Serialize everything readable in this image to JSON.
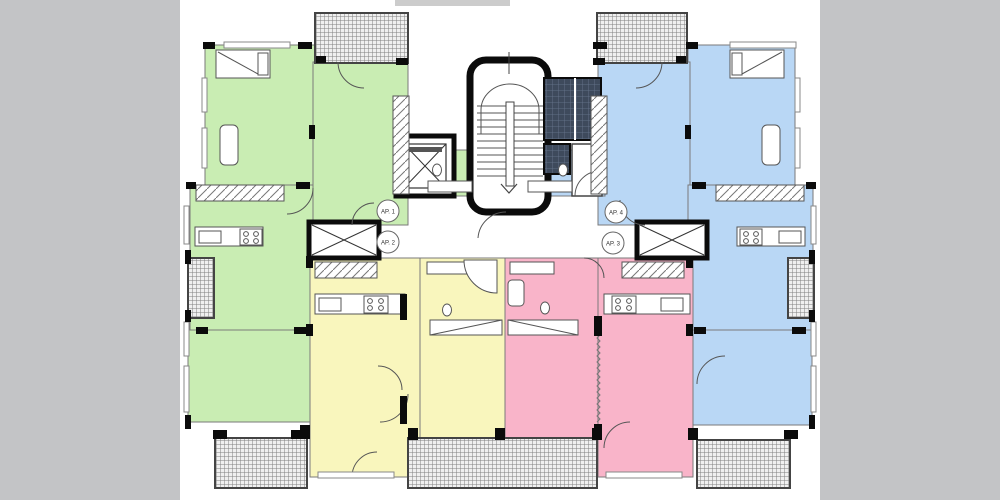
{
  "plan": {
    "title": "apartment-floor-plan",
    "apartment_labels": {
      "ap1": "AP. 1",
      "ap2": "AP. 2",
      "ap3": "AP. 3",
      "ap4": "AP. 4"
    }
  },
  "colors": {
    "background_gray": "#c3c4c6",
    "paper_white": "#ffffff",
    "apartment_green": "#c9edb3",
    "apartment_blue": "#b9d7f5",
    "apartment_yellow": "#f9f6bd",
    "apartment_pink": "#f9b4c9",
    "shaft_dark": "#3e4a5c",
    "shaft_grid_line": "#6a7890",
    "balcony_hatch_bg": "#f0f0f0",
    "balcony_hatch_line": "#808080",
    "wall_black": "#0b0b0b",
    "line_gray": "#555555",
    "label_text": "#333333"
  }
}
